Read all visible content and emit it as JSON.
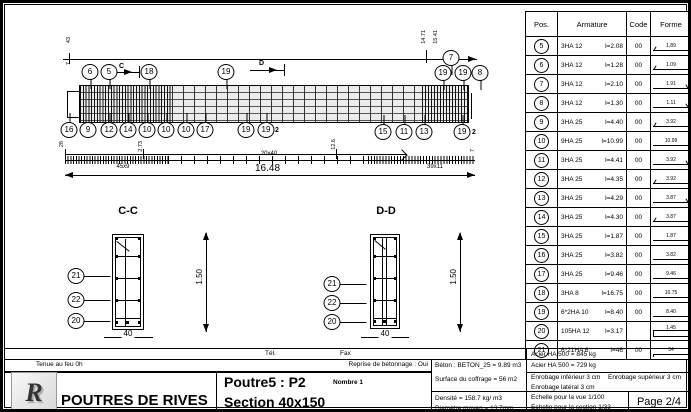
{
  "table": {
    "headers": [
      "Pos.",
      "Armature",
      "Code",
      "Forme"
    ],
    "rows": [
      {
        "pos": "5",
        "spec": "3HA 12",
        "len": "l=2.08",
        "code": "00",
        "forme": "1.89",
        "shape": "hook-left"
      },
      {
        "pos": "6",
        "spec": "3HA 12",
        "len": "l=1.28",
        "code": "00",
        "forme": "1.09",
        "shape": "hook-left"
      },
      {
        "pos": "7",
        "spec": "3HA 12",
        "len": "l=2.10",
        "code": "00",
        "forme": "1.91",
        "shape": "hook-right"
      },
      {
        "pos": "8",
        "spec": "3HA 12",
        "len": "l=1.30",
        "code": "00",
        "forme": "1.11",
        "shape": "hook-right"
      },
      {
        "pos": "9",
        "spec": "3HA 25",
        "len": "l=4.40",
        "code": "00",
        "forme": "3.92",
        "shape": "hook-left"
      },
      {
        "pos": "10",
        "spec": "9HA 25",
        "len": "l=10.99",
        "code": "00",
        "forme": "10.99",
        "shape": "straight"
      },
      {
        "pos": "11",
        "spec": "3HA 25",
        "len": "l=4.41",
        "code": "00",
        "forme": "3.92",
        "shape": "hook-right"
      },
      {
        "pos": "12",
        "spec": "3HA 25",
        "len": "l=4.35",
        "code": "00",
        "forme": "3.92",
        "shape": "hook-left"
      },
      {
        "pos": "13",
        "spec": "3HA 25",
        "len": "l=4.29",
        "code": "00",
        "forme": "3.87",
        "shape": "hook-right"
      },
      {
        "pos": "14",
        "spec": "3HA 25",
        "len": "l=4.30",
        "code": "00",
        "forme": "3.87",
        "shape": "hook-left"
      },
      {
        "pos": "15",
        "spec": "3HA 25",
        "len": "l=1.87",
        "code": "00",
        "forme": "1.87",
        "shape": "straight"
      },
      {
        "pos": "16",
        "spec": "3HA 25",
        "len": "l=3.82",
        "code": "00",
        "forme": "3.82",
        "shape": "straight"
      },
      {
        "pos": "17",
        "spec": "3HA 25",
        "len": "l=9.46",
        "code": "00",
        "forme": "9.46",
        "shape": "straight"
      },
      {
        "pos": "18",
        "spec": "3HA 8",
        "len": "l=16.75",
        "code": "00",
        "forme": "16.75",
        "shape": "straight"
      },
      {
        "pos": "19",
        "spec": "6*2HA 10",
        "len": "l=8.40",
        "code": "00",
        "forme": "8.40",
        "shape": "straight"
      },
      {
        "pos": "20",
        "spec": "105HA 12",
        "len": "l=3.17",
        "code": "",
        "forme": "1.45",
        "shape": "stirrup"
      },
      {
        "pos": "21",
        "spec": "6*21HA 6",
        "len": "l=46",
        "code": "00",
        "forme": "34",
        "shape": "hooks-down"
      }
    ]
  },
  "elevation": {
    "top_callouts": [
      {
        "n": "6",
        "x": 87,
        "y": 69
      },
      {
        "n": "5",
        "x": 106,
        "y": 69
      },
      {
        "n": "18",
        "x": 146,
        "y": 69
      },
      {
        "n": "19",
        "x": 223,
        "y": 69
      },
      {
        "n": "19",
        "x": 440,
        "y": 70
      },
      {
        "n": "7",
        "x": 448,
        "y": 55
      },
      {
        "n": "19",
        "x": 460,
        "y": 70
      },
      {
        "n": "8",
        "x": 477,
        "y": 70
      }
    ],
    "bottom_callouts": [
      {
        "n": "16",
        "x": 66,
        "y": 127
      },
      {
        "n": "9",
        "x": 85,
        "y": 127
      },
      {
        "n": "12",
        "x": 106,
        "y": 127
      },
      {
        "n": "14",
        "x": 125,
        "y": 127
      },
      {
        "n": "10",
        "x": 144,
        "y": 127
      },
      {
        "n": "10",
        "x": 163,
        "y": 127
      },
      {
        "n": "10",
        "x": 183,
        "y": 127
      },
      {
        "n": "17",
        "x": 202,
        "y": 127
      },
      {
        "n": "19",
        "x": 243,
        "y": 127
      },
      {
        "n": "19",
        "x": 263,
        "y": 127
      },
      {
        "n": "15",
        "x": 380,
        "y": 129
      },
      {
        "n": "11",
        "x": 401,
        "y": 129
      },
      {
        "n": "13",
        "x": 421,
        "y": 129
      },
      {
        "n": "19",
        "x": 459,
        "y": 129
      }
    ],
    "tiny_labels": [
      {
        "t": "2",
        "x": 272,
        "y": 124
      },
      {
        "t": "2",
        "x": 469,
        "y": 126
      },
      {
        "t": "C",
        "x": 116,
        "y": 60
      },
      {
        "t": "D",
        "x": 256,
        "y": 57
      }
    ],
    "rot_labels": [
      {
        "t": "43",
        "x": 64,
        "y": 34
      },
      {
        "t": "7",
        "x": 64,
        "y": 59
      },
      {
        "t": "14.71",
        "x": 419,
        "y": 27
      },
      {
        "t": "15.41",
        "x": 431,
        "y": 27
      },
      {
        "t": "28",
        "x": 57,
        "y": 138
      },
      {
        "t": "2.73",
        "x": 136,
        "y": 138
      },
      {
        "t": "12.6",
        "x": 329,
        "y": 136
      },
      {
        "t": "7",
        "x": 468,
        "y": 146
      }
    ],
    "spacing_labels": [
      {
        "t": "45x9",
        "x": 120,
        "y": 161
      },
      {
        "t": "20x40",
        "x": 266,
        "y": 148
      },
      {
        "t": "39x11",
        "x": 432,
        "y": 161
      }
    ],
    "total_dim": "16.48"
  },
  "sections": {
    "cc": {
      "title": "C-C",
      "callouts": [
        {
          "n": "21",
          "x": 73,
          "y": 273
        },
        {
          "n": "22",
          "x": 73,
          "y": 297
        },
        {
          "n": "20",
          "x": 73,
          "y": 318
        }
      ],
      "width": "40",
      "height": "1.50"
    },
    "dd": {
      "title": "D-D",
      "callouts": [
        {
          "n": "21",
          "x": 329,
          "y": 281
        },
        {
          "n": "22",
          "x": 329,
          "y": 300
        },
        {
          "n": "20",
          "x": 329,
          "y": 319
        }
      ],
      "width": "40",
      "height": "1.50"
    }
  },
  "titleblock": {
    "tel_label": "Tél.",
    "fax_label": "Fax",
    "fire": "Tenue au feu 0h",
    "reprise": "Reprise de bétonnage : Oui",
    "project": "POUTRES DE RIVES",
    "beam_name": "Poutre5 : P2",
    "section_label": "Section 40x150",
    "nombre": "Nombre 1",
    "beton": "Béton : BETON_25 = 9.89 m3",
    "coffrage": "Surface du coffrage = 56 m2",
    "densite": "Densité = 158.7 kg/ m3",
    "diametre": "Diamètre moyen = 13.7mm",
    "acier1": "Acier HA 500 = 845 kg",
    "acier2": "Acier HA 500 = 729 kg",
    "enrobage_inf": "Enrobage inférieur 3 cm",
    "enrobage_sup": "Enrobage supérieur 3 cm",
    "enrobage_lat": "Enrobage latéral 3 cm",
    "echelle_vue": "Echelle pour la vue 1/100",
    "echelle_section": "Echelle pour la section 1/33",
    "page": "Page 2/4",
    "logo": "R"
  }
}
